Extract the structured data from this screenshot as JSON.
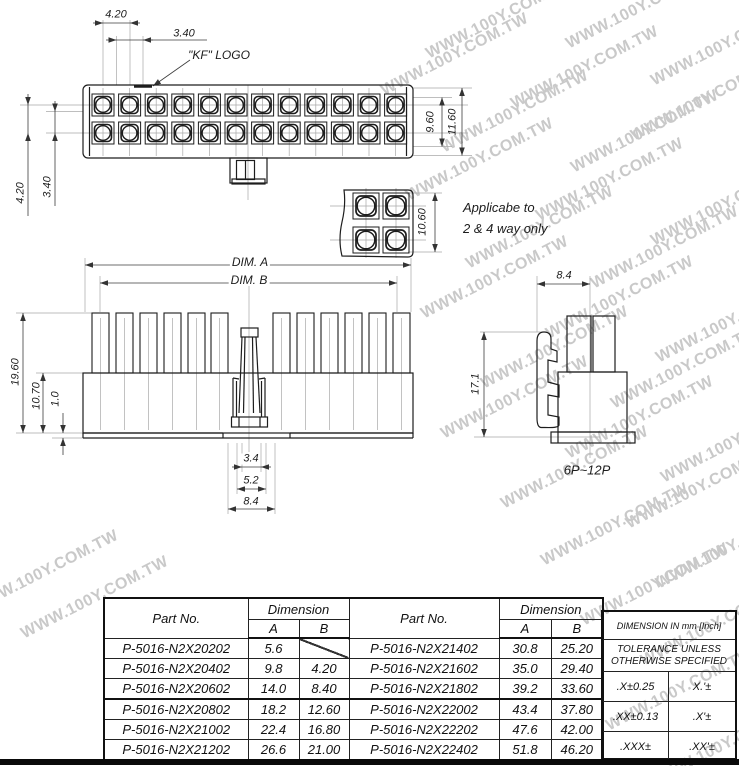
{
  "watermark": {
    "text": "WWW.100Y.COM.TW",
    "color": "#c9c9c9"
  },
  "drawing": {
    "labels": {
      "pitch_h": "4.20",
      "pin_w": "3.40",
      "kf": "\"KF\" LOGO",
      "h_inner": "9.60",
      "h_outer": "11.60",
      "pitch_v": "4.20",
      "pin_h": "3.40",
      "small_h": "10.60",
      "note1": "Applicabe to",
      "note2": "2 & 4 way only",
      "dim_a": "DIM. A",
      "dim_b": "DIM. B",
      "total_h": "19.60",
      "body_h": "10.70",
      "lip": "1.0",
      "slot_w1": "3.4",
      "slot_w2": "5.2",
      "slot_w3": "8.4",
      "end_w": "8.4",
      "end_h": "17.1",
      "range": "6P~12P"
    }
  },
  "table": {
    "header_part": "Part No.",
    "header_dim": "Dimension",
    "col_a": "A",
    "col_b": "B",
    "left_rows": [
      {
        "part": "P-5016-N2X20202",
        "a": "5.6",
        "b": ""
      },
      {
        "part": "P-5016-N2X20402",
        "a": "9.8",
        "b": "4.20"
      },
      {
        "part": "P-5016-N2X20602",
        "a": "14.0",
        "b": "8.40"
      },
      {
        "part": "P-5016-N2X20802",
        "a": "18.2",
        "b": "12.60"
      },
      {
        "part": "P-5016-N2X21002",
        "a": "22.4",
        "b": "16.80"
      },
      {
        "part": "P-5016-N2X21202",
        "a": "26.6",
        "b": "21.00"
      }
    ],
    "right_rows": [
      {
        "part": "P-5016-N2X21402",
        "a": "30.8",
        "b": "25.20"
      },
      {
        "part": "P-5016-N2X21602",
        "a": "35.0",
        "b": "29.40"
      },
      {
        "part": "P-5016-N2X21802",
        "a": "39.2",
        "b": "33.60"
      },
      {
        "part": "P-5016-N2X22002",
        "a": "43.4",
        "b": "37.80"
      },
      {
        "part": "P-5016-N2X22202",
        "a": "47.6",
        "b": "42.00"
      },
      {
        "part": "P-5016-N2X22402",
        "a": "51.8",
        "b": "46.20"
      }
    ]
  },
  "tolerance": {
    "title": "DIMENSION IN mm [Inch]",
    "subtitle1": "TOLERANCE UNLESS",
    "subtitle2": "OTHERWISE SPECIFIED",
    "rows": [
      {
        "mm": ".X±0.25",
        "inch": "X.'±"
      },
      {
        "mm": ".XX±0.13",
        "inch": ".X'±"
      },
      {
        "mm": ".XXX±",
        "inch": ".XX'±"
      }
    ]
  }
}
